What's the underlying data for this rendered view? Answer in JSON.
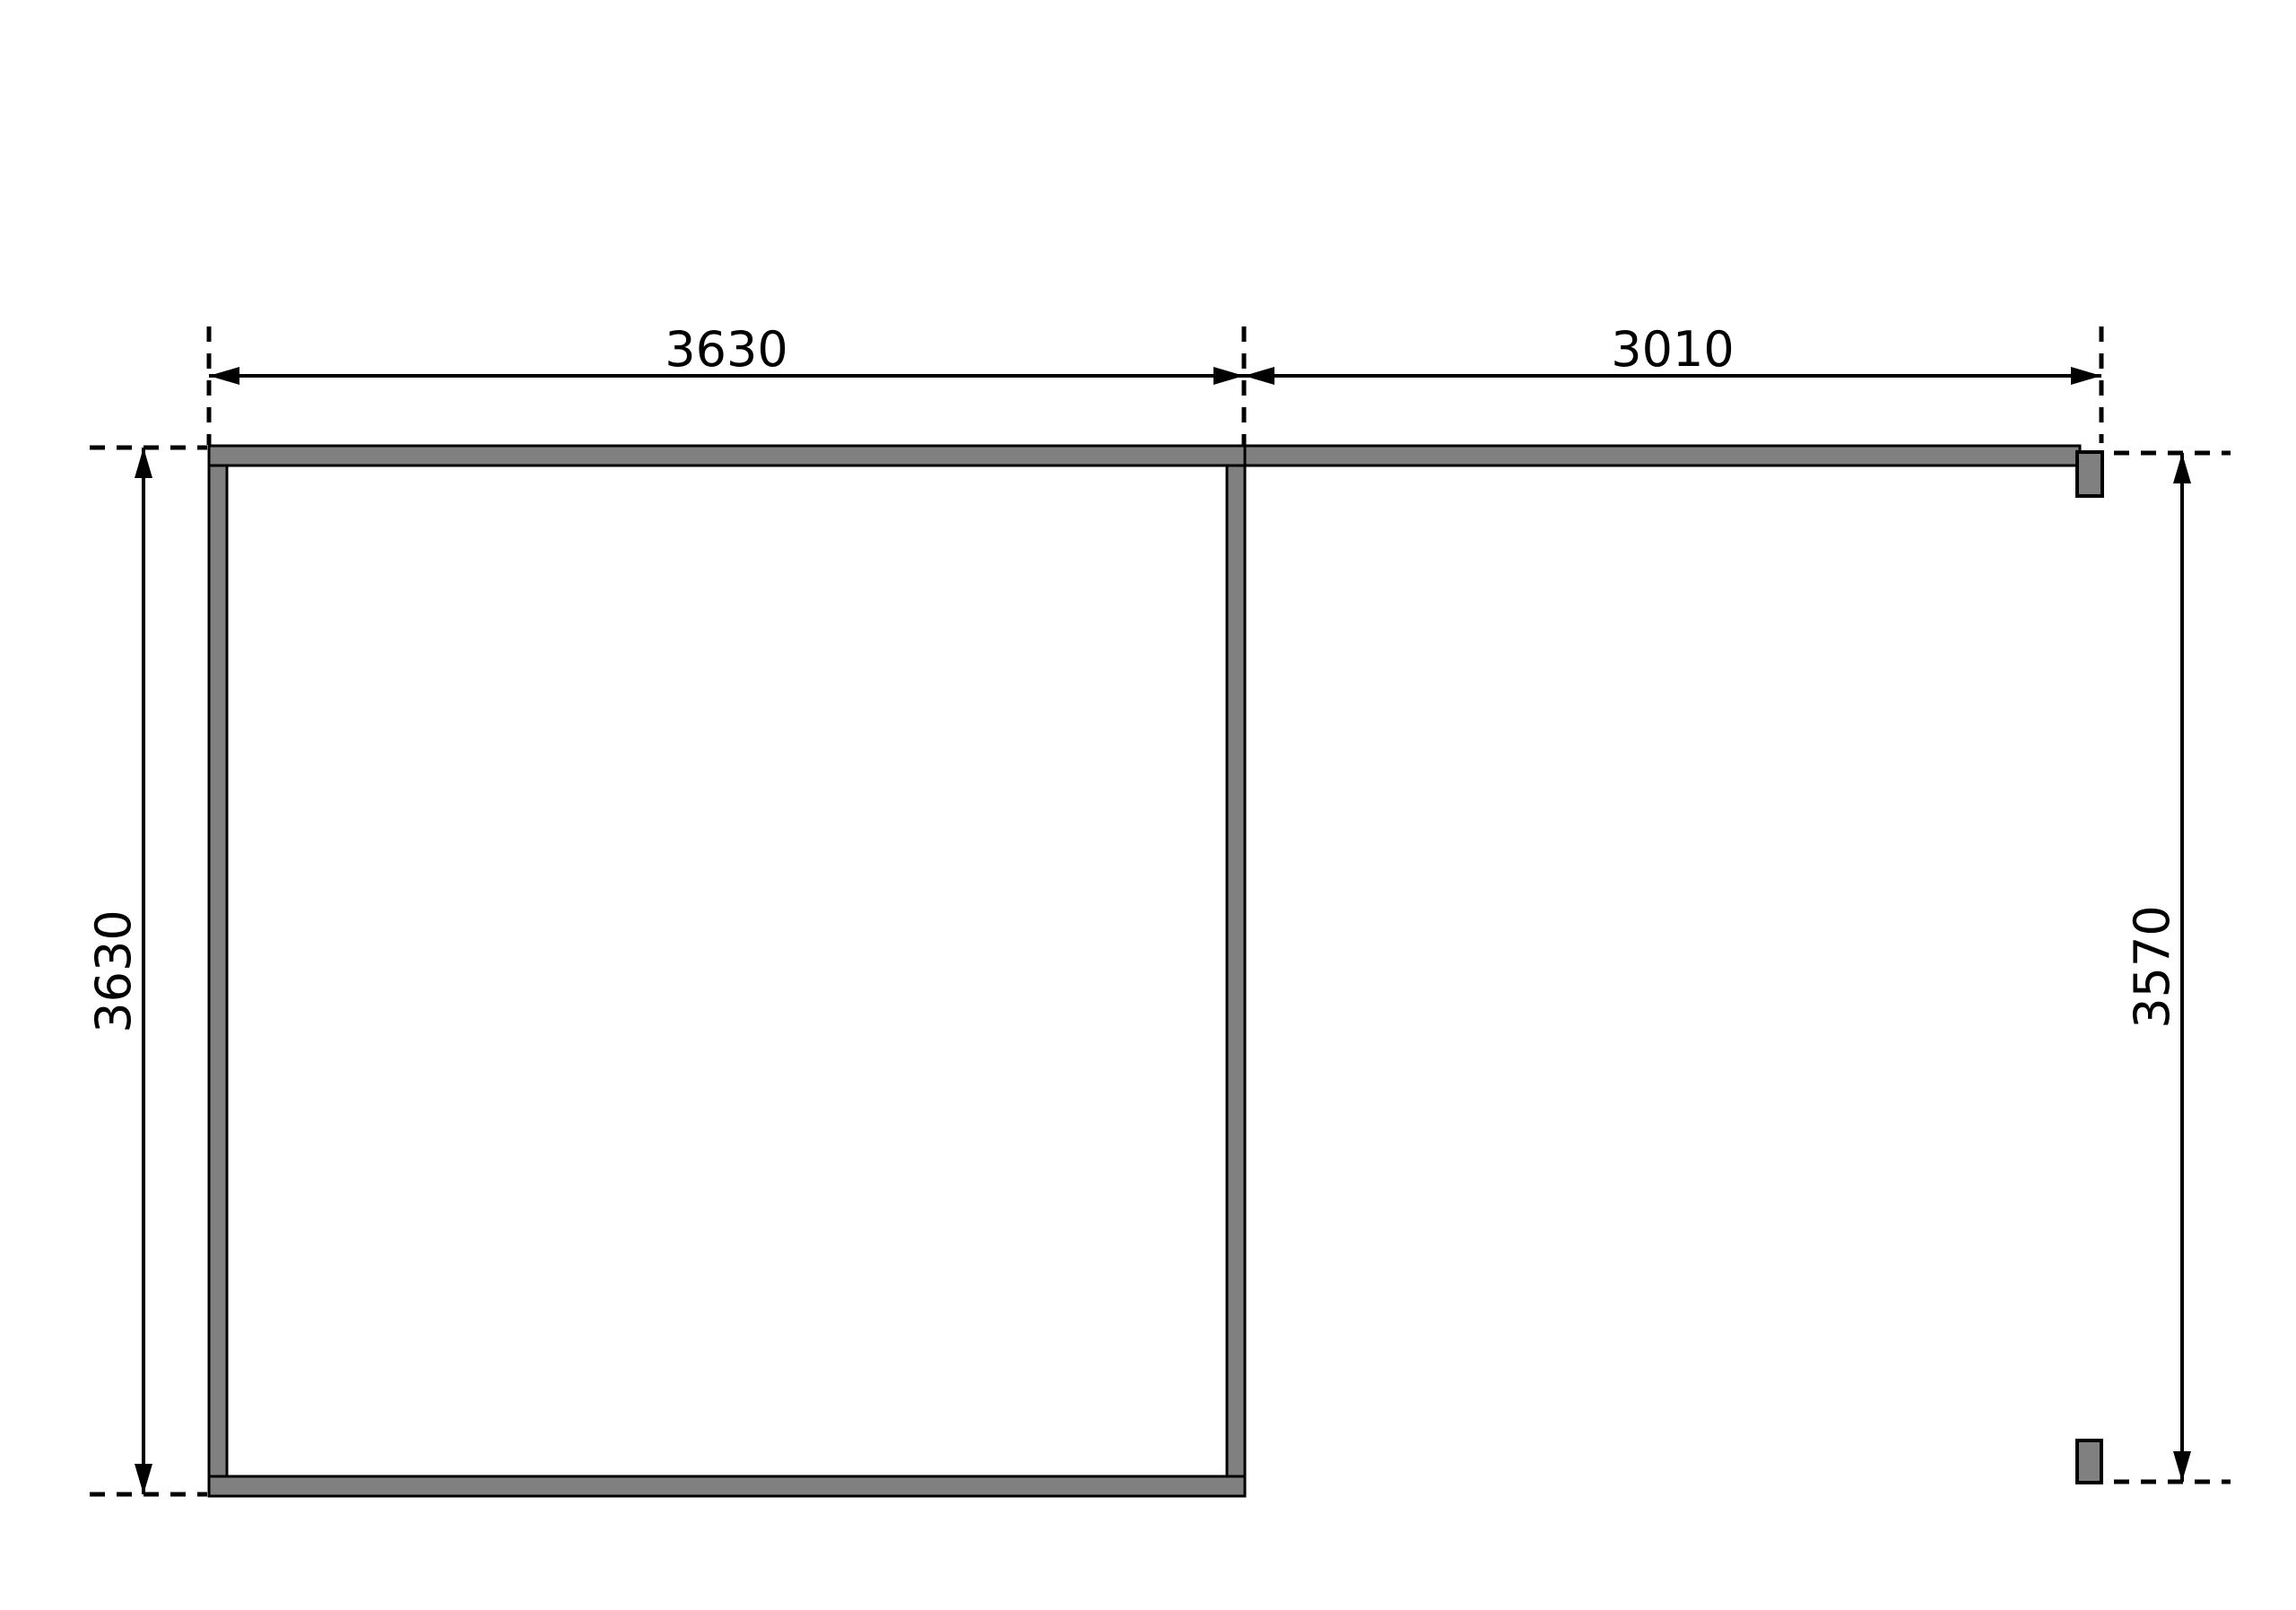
{
  "diagram": {
    "colors": {
      "background": "#ffffff",
      "wall_fill": "#808080",
      "line": "#000000"
    },
    "dimension_labels": {
      "top_left": "3630",
      "top_right": "3010",
      "left": "3630",
      "right": "3570"
    }
  }
}
